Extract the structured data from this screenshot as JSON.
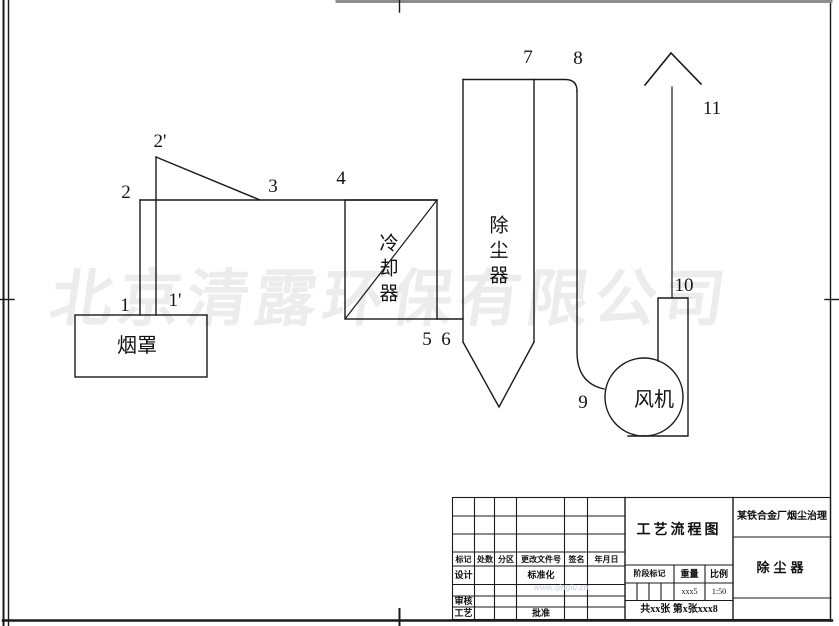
{
  "watermark": {
    "company": "北京清露环保有限公司",
    "url": "www.qinglu.cn"
  },
  "diagram": {
    "equipment": {
      "hood": "烟罩",
      "cooler": "冷却器",
      "collector": "除尘器",
      "fan": "风机"
    },
    "point_labels": [
      "1",
      "1'",
      "2",
      "2'",
      "3",
      "4",
      "5",
      "6",
      "7",
      "8",
      "9",
      "10",
      "11"
    ]
  },
  "titleblock": {
    "drawing_title": "工艺流程图",
    "project_title": "某铁合金厂烟尘治理",
    "part_title": "除尘器",
    "rev_headers": [
      "标记",
      "处数",
      "分区",
      "更改文件号",
      "签名",
      "年月日"
    ],
    "roles": {
      "design": "设计",
      "standardization": "标准化",
      "review": "审核",
      "process": "工艺",
      "approve": "批准"
    },
    "stage_label": "阶段标记",
    "weight_label": "重量",
    "scale_label": "比例",
    "weight_value": "xxx5",
    "scale_value": "1:50",
    "sheet_info": "共xx张 第x张xxx8"
  }
}
